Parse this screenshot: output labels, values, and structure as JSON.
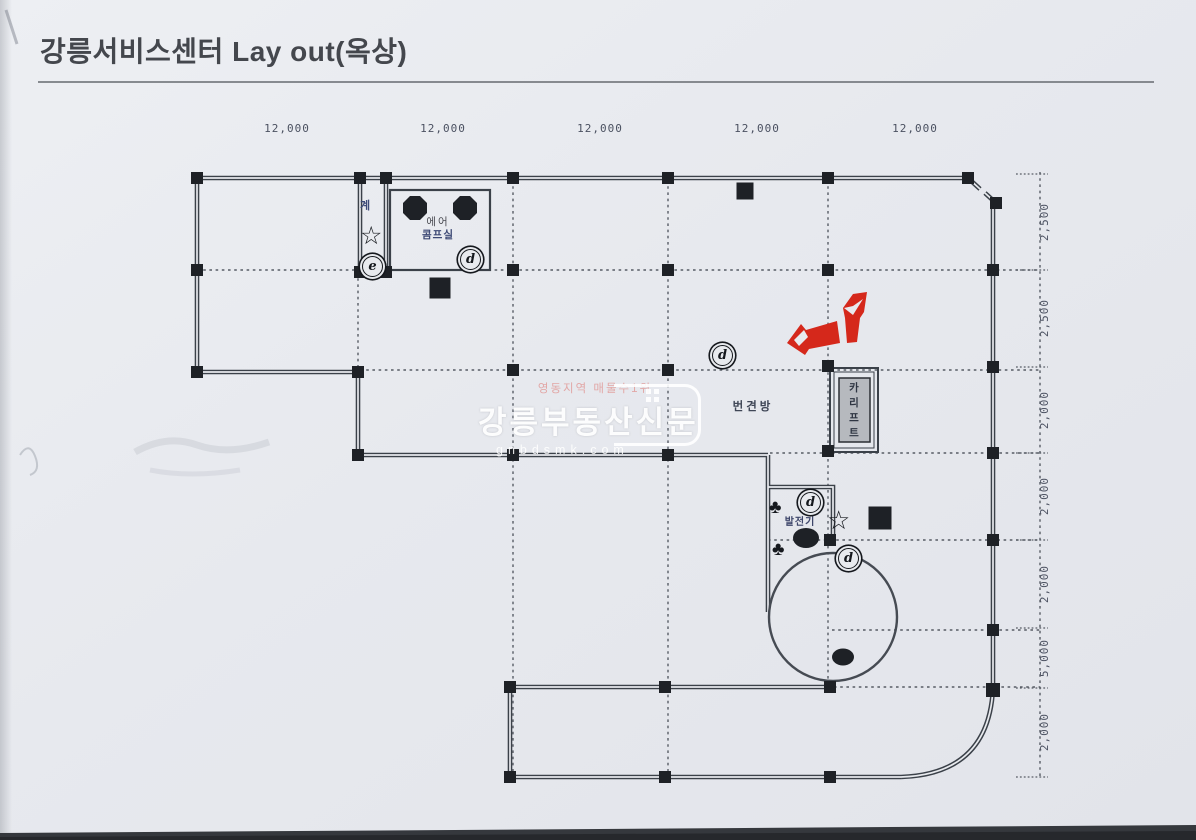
{
  "document": {
    "title": "강릉서비스센터 Lay out(옥상)"
  },
  "dimensions": {
    "top": [
      "12,000",
      "12,000",
      "12,000",
      "12,000",
      "12,000"
    ],
    "right": [
      "2,500",
      "2,500",
      "2,000",
      "2,000",
      "2,000",
      "5,000",
      "2,000"
    ]
  },
  "labels": {
    "stairs": "계",
    "air_room_line1": "에어",
    "air_room_line2": "콤프실",
    "middle_room": "번견방",
    "generator": "발전기",
    "car_lift": [
      "카",
      "리",
      "프",
      "트"
    ]
  },
  "markers": {
    "d": "d",
    "e": "e",
    "star": "☆",
    "club": "♣"
  },
  "watermark": {
    "tagline": "영동지역 매물수1위",
    "name": "강릉부동산신문",
    "url": "gnbdsmk.com"
  },
  "colors": {
    "wall_line": "#3b4149",
    "column_marker": "#1e2126",
    "arrow_red": "#d5281b",
    "paper": "#e7e9ee"
  }
}
